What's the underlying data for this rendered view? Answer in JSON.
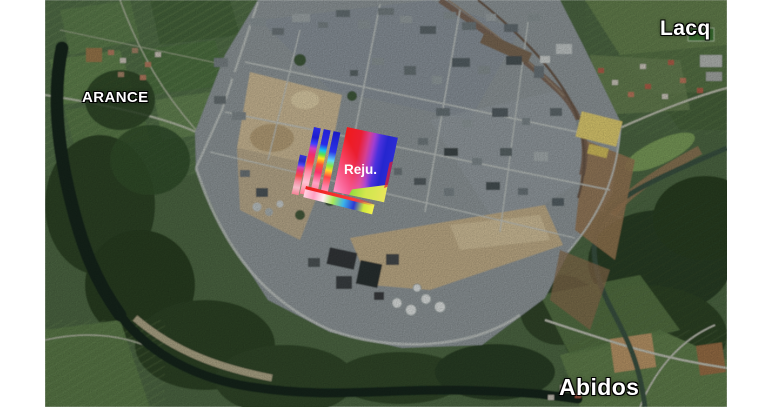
{
  "canvas": {
    "background": "#ffffff"
  },
  "map": {
    "kind": "satellite-aerial-view",
    "labels": [
      {
        "id": "arance",
        "text": "ARANCE"
      },
      {
        "id": "lacq",
        "text": "Lacq"
      },
      {
        "id": "abidos",
        "text": "Abidos"
      }
    ],
    "label_style": {
      "fill": "#ffffff",
      "outline": "#000000"
    }
  },
  "overlay": {
    "label": "Reju.",
    "palette": {
      "red": "#ee1c1c",
      "blue": "#2525cf",
      "purple": "#a13ed0",
      "pink": "#ff8fc8",
      "lime": "#a9e847",
      "yellow": "#ffe41c",
      "cyan": "#33c4f2"
    }
  }
}
